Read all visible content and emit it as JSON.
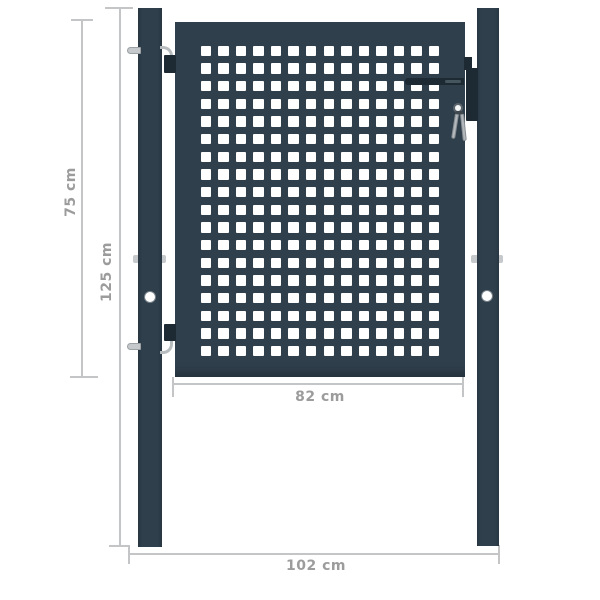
{
  "diagram": {
    "kind": "product dimension drawing",
    "subject": "garden gate with perforated square-mesh panel, two posts, hinges and lock with keys"
  },
  "colors": {
    "anthracite": "#2f3f4c",
    "anthracite_deep": "#283642",
    "hardware_dark": "#1d2933",
    "hardware_light": "#b7bcbf",
    "bracket_light": "#c6c9cb",
    "dimension_line": "#c3c5c6",
    "label_text": "#9c9c9c",
    "hole_white": "#ffffff"
  },
  "gate": {
    "grid_rows": 18,
    "grid_cols": 14
  },
  "hardware": {
    "key_count": 2,
    "hinge_count": 2
  },
  "dimensions": {
    "gate_height": {
      "label": "75 cm",
      "orientation": "vertical"
    },
    "post_height": {
      "label": "125 cm",
      "orientation": "vertical"
    },
    "gate_width": {
      "label": "82 cm",
      "orientation": "horizontal"
    },
    "overall_width": {
      "label": "102 cm",
      "orientation": "horizontal"
    }
  }
}
